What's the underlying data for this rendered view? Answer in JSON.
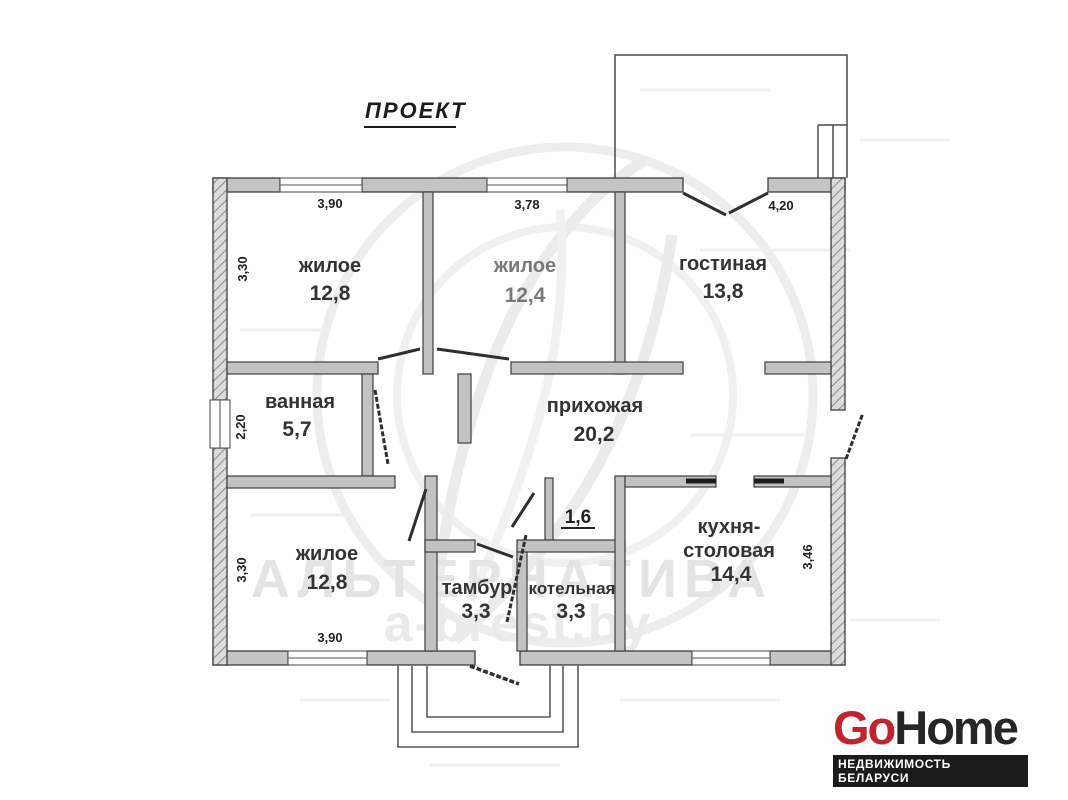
{
  "title": "ПРОЕКТ",
  "rooms": [
    {
      "name": "жилое",
      "area": "12,8"
    },
    {
      "name": "жилое",
      "area": "12,4"
    },
    {
      "name": "гостиная",
      "area": "13,8"
    },
    {
      "name": "ванная",
      "area": "5,7"
    },
    {
      "name": "прихожая",
      "area": "20,2"
    },
    {
      "name": "жилое",
      "area": "12,8"
    },
    {
      "name": "тамбур",
      "area": "3,3"
    },
    {
      "name": "котельная",
      "area": "3,3"
    },
    {
      "name": "кухня-",
      "name2": "столовая",
      "area": "14,4"
    }
  ],
  "niche": {
    "label": "1,6"
  },
  "dims": {
    "top_room1": "3,90",
    "top_room2": "3,78",
    "top_room3": "4,20",
    "side_room1": "3,30",
    "side_bathroom": "2,20",
    "side_room5": "3,30",
    "bottom_room5": "3,90",
    "side_kitchen": "3,46"
  },
  "watermark": {
    "brand": "АЛЬТЕРНАТИВА",
    "site": "a-brest.by"
  },
  "logo": {
    "part1": "Go",
    "part2": "Home",
    "tagline": "НЕДВИЖИМОСТЬ БЕЛАРУСИ",
    "accent_color": "#c3232a",
    "text_color": "#262626",
    "bar_color": "#1b1b1b"
  },
  "colors": {
    "wall_fill": "#c4c4c4",
    "wall_outline": "#3e3e3e",
    "label_text": "#333333",
    "watermark_text": "#e4e4e4"
  }
}
